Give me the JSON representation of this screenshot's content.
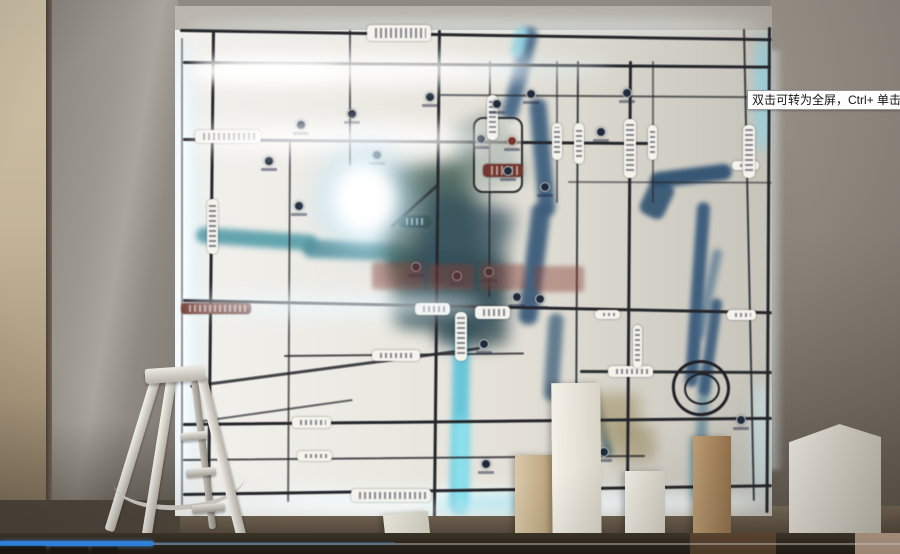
{
  "video_player": {
    "tooltip": "双击可转为全屏，Ctrl+ 单击可转为",
    "progress_fraction": 0.17,
    "progress_color": "#2e7fd8"
  },
  "scene": {
    "map": {
      "glows_under": [
        [
          168,
          40,
          30,
          470,
          "#dff2fc",
          8,
          0.9
        ],
        [
          175,
          55,
          15,
          445,
          "#ffffff",
          5,
          0.95
        ],
        [
          185,
          20,
          580,
          12,
          "#e9f5fa",
          6,
          0.55
        ],
        [
          754,
          34,
          18,
          120,
          "#8fd0e0",
          5,
          0.8
        ],
        [
          182,
          490,
          590,
          24,
          "#f4fdff",
          8,
          0.95
        ],
        [
          430,
          496,
          140,
          18,
          "#a8e6f2",
          7,
          0.85
        ],
        [
          752,
          380,
          20,
          120,
          "#cdeef6",
          7,
          0.7
        ]
      ],
      "glows_over": [
        [
          190,
          56,
          340,
          28,
          "#ffffff",
          10,
          0.95
        ],
        [
          193,
          60,
          150,
          22,
          "#ffffff",
          6,
          1
        ],
        [
          470,
          60,
          140,
          16,
          "#e2f2f8",
          8,
          0.55
        ],
        [
          190,
          124,
          300,
          28,
          "#ffffff",
          10,
          0.95
        ],
        [
          320,
          150,
          92,
          100,
          "#c2e6f8",
          16,
          0.85
        ],
        [
          332,
          162,
          64,
          74,
          "#ffffff",
          8,
          1
        ],
        [
          183,
          294,
          300,
          22,
          "#eefaff",
          9,
          0.75
        ],
        [
          200,
          505,
          540,
          10,
          "#ffffff",
          6,
          0.4
        ]
      ],
      "rivers": [
        [
          512,
          26,
          16,
          95,
          14,
          "#47688a",
          3,
          0.95
        ],
        [
          534,
          98,
          17,
          118,
          -5,
          "#3e6080",
          3,
          0.95
        ],
        [
          525,
          203,
          19,
          122,
          7,
          "#3a5c7c",
          3,
          0.95
        ],
        [
          546,
          313,
          15,
          88,
          4,
          "#436580",
          3,
          0.8
        ],
        [
          513,
          26,
          13,
          32,
          14,
          "#96d6e6",
          3,
          0.9
        ],
        [
          650,
          168,
          82,
          16,
          -7,
          "#2f5272",
          2,
          0.95
        ],
        [
          644,
          180,
          26,
          38,
          25,
          "#2f5272",
          2,
          0.9
        ],
        [
          691,
          202,
          13,
          185,
          4,
          "#375a7c",
          2,
          0.95
        ],
        [
          697,
          368,
          11,
          92,
          3,
          "#4a7a90",
          3,
          0.65
        ],
        [
          692,
          438,
          12,
          62,
          2,
          "#72cadd",
          4,
          0.8
        ],
        [
          704,
          248,
          9,
          92,
          12,
          "#40698a",
          3,
          0.65
        ],
        [
          705,
          298,
          11,
          98,
          8,
          "#375a7c",
          2,
          0.9
        ],
        [
          452,
          293,
          17,
          220,
          1,
          "#5ec5da",
          3,
          0.95
        ],
        [
          453,
          418,
          16,
          96,
          1,
          "#8fe6f2",
          4,
          0.85
        ],
        [
          196,
          231,
          122,
          16,
          4,
          "#539daa",
          3,
          0.9
        ],
        [
          303,
          241,
          98,
          18,
          2,
          "#4f909c",
          3,
          0.9
        ],
        [
          388,
          250,
          78,
          21,
          7,
          "#3f7e92",
          4,
          0.9
        ],
        [
          384,
          165,
          98,
          155,
          -10,
          "#3e5a52",
          9,
          0.85
        ],
        [
          412,
          198,
          88,
          135,
          15,
          "#34505e",
          9,
          0.8
        ],
        [
          436,
          258,
          72,
          88,
          0,
          "#314c54",
          8,
          0.8
        ],
        [
          460,
          118,
          56,
          72,
          -20,
          "#4c6a62",
          8,
          0.6
        ],
        [
          596,
          388,
          10,
          70,
          -15,
          "#406674",
          3,
          0.85
        ],
        [
          582,
          393,
          58,
          46,
          0,
          "#a4966d",
          7,
          0.65
        ],
        [
          610,
          426,
          46,
          36,
          0,
          "#9a8b63",
          7,
          0.6
        ],
        [
          698,
          452,
          28,
          18,
          0,
          "#5d8d98",
          5,
          0.55
        ]
      ],
      "roads_h": [
        [
          180,
          29,
          592,
          3,
          0.9,
          1
        ],
        [
          183,
          61,
          588,
          3,
          0.45,
          1
        ],
        [
          440,
          94,
          332,
          2,
          0.4,
          0.7
        ],
        [
          183,
          138,
          465,
          3,
          0.5,
          1
        ],
        [
          568,
          181,
          204,
          2,
          0.2,
          0.55
        ],
        [
          183,
          299,
          589,
          3,
          1.2,
          1
        ],
        [
          284,
          355,
          240,
          2,
          -0.6,
          0.8
        ],
        [
          580,
          370,
          192,
          3,
          0.3,
          0.95
        ],
        [
          183,
          423,
          589,
          3,
          -0.6,
          1
        ],
        [
          183,
          459,
          462,
          2,
          -0.5,
          0.8
        ],
        [
          183,
          493,
          589,
          3,
          -0.85,
          1
        ],
        [
          190,
          385,
          292,
          2.5,
          -7.5,
          0.85
        ],
        [
          196,
          421,
          158,
          2,
          -8,
          0.7
        ],
        [
          390,
          226,
          64,
          2.5,
          -42,
          0.85
        ]
      ],
      "roads_v": [
        [
          212,
          30,
          472,
          2.5,
          0.6,
          1
        ],
        [
          289,
          140,
          362,
          1.8,
          0.3,
          0.7
        ],
        [
          349,
          30,
          136,
          1.8,
          0,
          0.75
        ],
        [
          438,
          30,
          487,
          3,
          0.6,
          1
        ],
        [
          489,
          61,
          236,
          1.8,
          0.2,
          0.75
        ],
        [
          556,
          61,
          142,
          1.5,
          0,
          0.6
        ],
        [
          577,
          61,
          450,
          2,
          0.3,
          0.85
        ],
        [
          629,
          61,
          450,
          2.5,
          0.4,
          1
        ],
        [
          652,
          61,
          142,
          1.5,
          0,
          0.6
        ],
        [
          743,
          29,
          472,
          2,
          -1.2,
          0.85
        ],
        [
          768,
          27,
          486,
          2.5,
          0.3,
          1
        ],
        [
          181,
          38,
          468,
          2,
          0,
          0.5
        ]
      ],
      "labels": [
        [
          367,
          25,
          64,
          16,
          "w",
          0
        ],
        [
          195,
          130,
          66,
          13,
          "w",
          0
        ],
        [
          181,
          303,
          70,
          11,
          "r",
          0
        ],
        [
          415,
          303,
          35,
          12,
          "w",
          0
        ],
        [
          475,
          306,
          35,
          13,
          "w",
          0
        ],
        [
          483,
          164,
          40,
          13,
          "r",
          0
        ],
        [
          399,
          216,
          31,
          11,
          "t",
          0
        ],
        [
          372,
          350,
          48,
          11,
          "w",
          0
        ],
        [
          292,
          417,
          39,
          11,
          "w",
          0
        ],
        [
          297,
          451,
          35,
          10,
          "w",
          0
        ],
        [
          351,
          489,
          80,
          13,
          "w",
          0
        ],
        [
          608,
          366,
          45,
          11,
          "w",
          0
        ],
        [
          595,
          310,
          25,
          9,
          "w",
          0
        ],
        [
          727,
          310,
          29,
          10,
          "w",
          0
        ],
        [
          732,
          161,
          27,
          9,
          "w",
          0
        ],
        [
          207,
          199,
          11,
          55,
          "w",
          1
        ],
        [
          487,
          95,
          11,
          45,
          "w",
          1
        ],
        [
          552,
          123,
          10,
          37,
          "w",
          1
        ],
        [
          574,
          123,
          10,
          41,
          "w",
          1
        ],
        [
          624,
          119,
          12,
          59,
          "w",
          1
        ],
        [
          648,
          125,
          9,
          35,
          "w",
          1
        ],
        [
          743,
          125,
          12,
          53,
          "w",
          1
        ],
        [
          633,
          325,
          9,
          43,
          "w",
          1
        ],
        [
          455,
          312,
          12,
          49,
          "w",
          1
        ]
      ],
      "pois": [
        [
          269,
          161,
          0
        ],
        [
          301,
          125,
          0
        ],
        [
          352,
          114,
          0
        ],
        [
          377,
          155,
          0
        ],
        [
          299,
          206,
          0
        ],
        [
          497,
          104,
          0
        ],
        [
          531,
          94,
          0
        ],
        [
          481,
          139,
          0
        ],
        [
          512,
          141,
          1
        ],
        [
          508,
          171,
          0
        ],
        [
          601,
          132,
          0
        ],
        [
          545,
          187,
          0
        ],
        [
          540,
          299,
          0
        ],
        [
          489,
          272,
          0
        ],
        [
          457,
          276,
          0
        ],
        [
          416,
          267,
          0
        ],
        [
          517,
          297,
          0
        ],
        [
          484,
          344,
          0
        ],
        [
          560,
          424,
          0
        ],
        [
          604,
          452,
          0
        ],
        [
          741,
          420,
          0
        ],
        [
          486,
          464,
          0
        ],
        [
          430,
          97,
          0
        ],
        [
          627,
          93,
          0
        ]
      ],
      "watermark": [
        [
          372,
          262,
          52,
          28
        ],
        [
          428,
          264,
          46,
          26
        ],
        [
          480,
          264,
          46,
          26
        ],
        [
          534,
          266,
          50,
          26
        ]
      ]
    },
    "boxes": [
      {
        "x": 515,
        "y": 455,
        "w": 44,
        "h": 99,
        "c1": "#d9c8a8",
        "c2": "#b39a72",
        "rot": 0
      },
      {
        "x": 552,
        "y": 383,
        "w": 49,
        "h": 171,
        "c1": "#f4f1e9",
        "c2": "#d9d4c8",
        "rot": -0.5
      },
      {
        "x": 625,
        "y": 471,
        "w": 40,
        "h": 83,
        "c1": "#efede5",
        "c2": "#d5d1c5",
        "rot": 0
      },
      {
        "x": 693,
        "y": 436,
        "w": 38,
        "h": 118,
        "c1": "#c0a076",
        "c2": "#96754e",
        "rot": 0
      },
      {
        "x": 789,
        "y": 424,
        "w": 92,
        "h": 130,
        "c1": "#f1eee6",
        "c2": "#d2cdc1",
        "rot": 0,
        "clip": "polygon(0 14%, 55% 0, 100% 10%, 100% 100%, 0 100%)"
      },
      {
        "x": 385,
        "y": 513,
        "w": 45,
        "h": 41,
        "c1": "#ece9de",
        "c2": "#cfccc0",
        "rot": -6
      }
    ],
    "wm_bottom": [
      [
        0,
        546,
        46,
        8
      ],
      [
        50,
        547,
        38,
        7
      ],
      [
        92,
        547,
        26,
        7
      ]
    ]
  }
}
